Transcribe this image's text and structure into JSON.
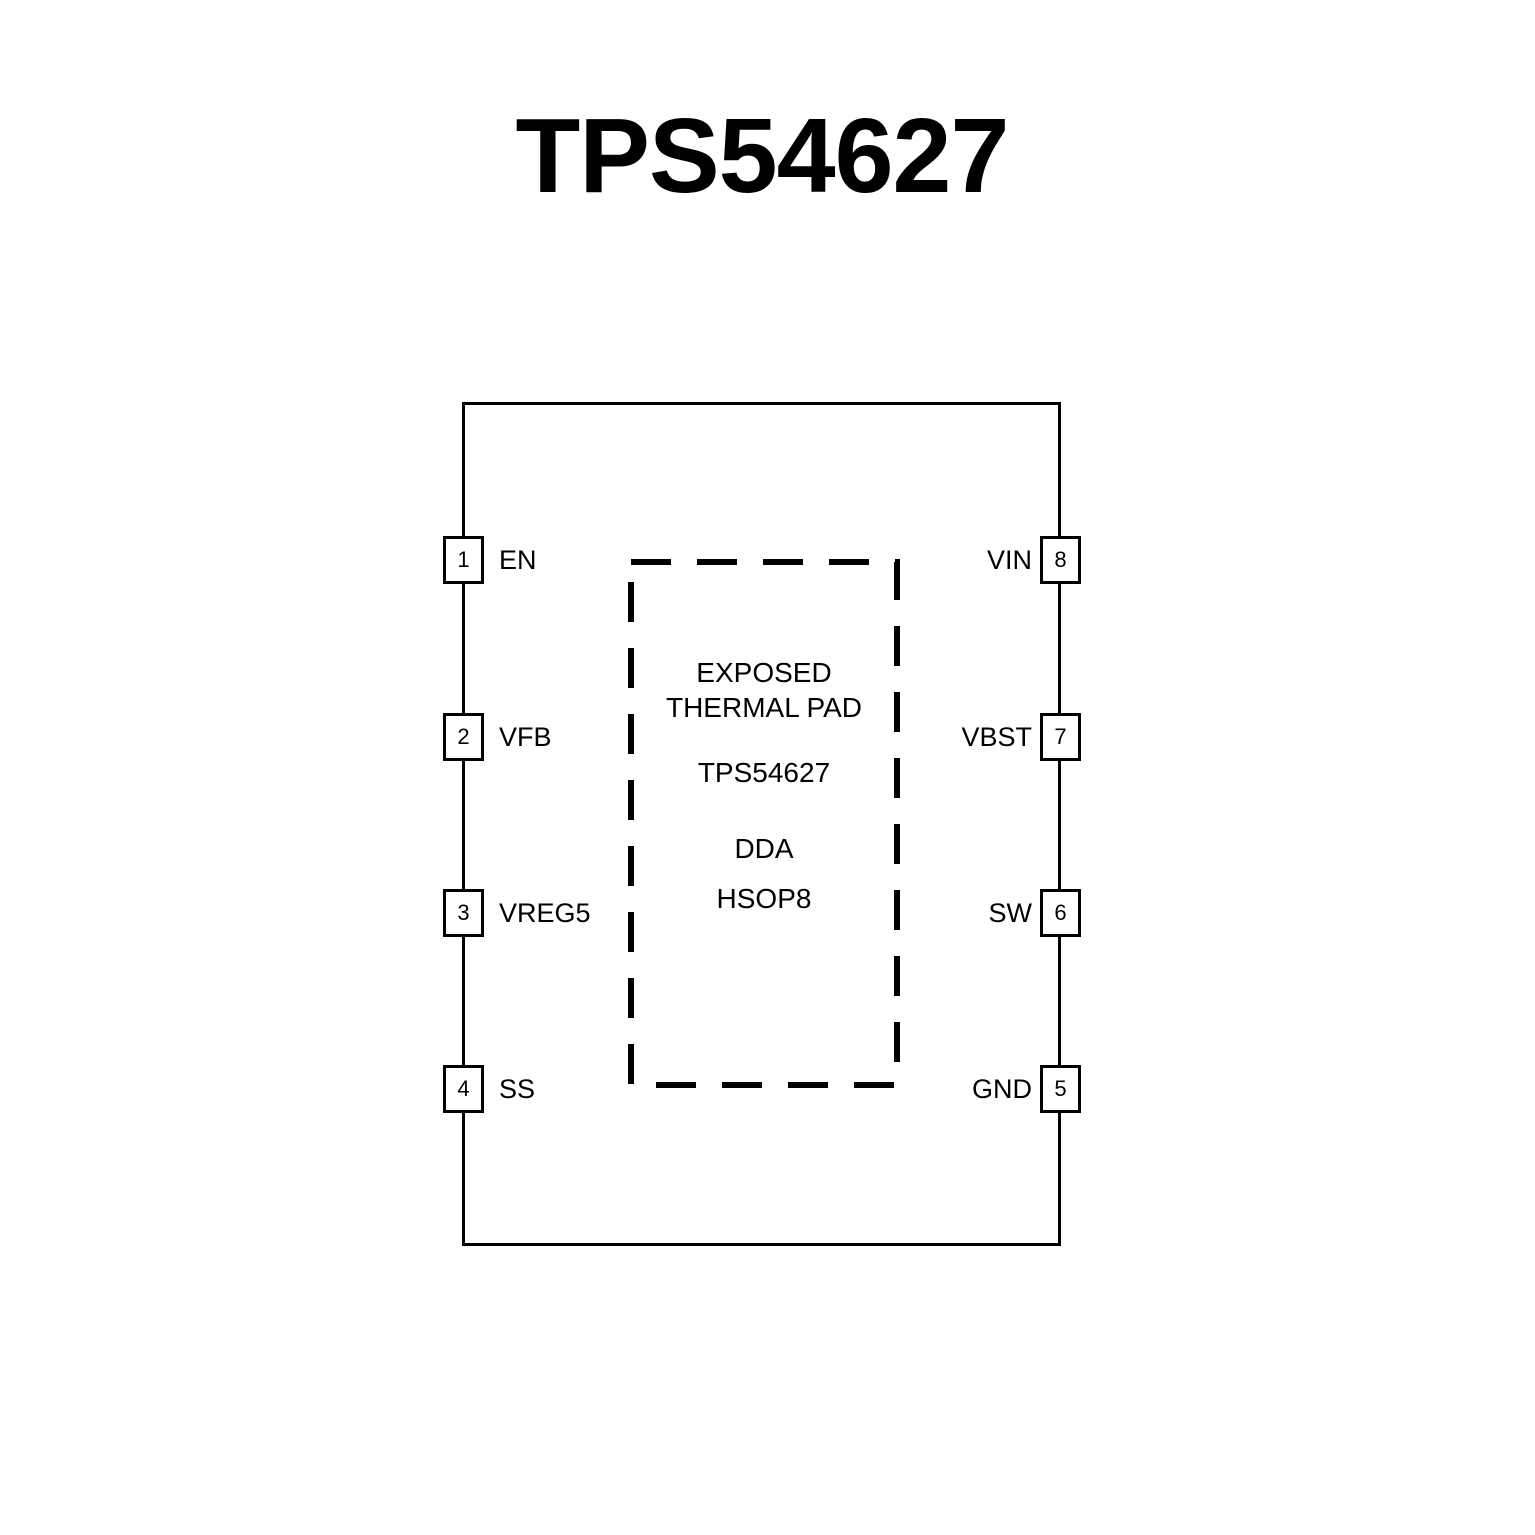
{
  "title": "TPS54627",
  "thermal_pad": {
    "line1": "EXPOSED",
    "line2": "THERMAL PAD",
    "part_number": "TPS54627",
    "package_code": "DDA",
    "package_name": "HSOP8"
  },
  "pins": {
    "left": [
      {
        "number": "1",
        "label": "EN"
      },
      {
        "number": "2",
        "label": "VFB"
      },
      {
        "number": "3",
        "label": "VREG5"
      },
      {
        "number": "4",
        "label": "SS"
      }
    ],
    "right": [
      {
        "number": "8",
        "label": "VIN"
      },
      {
        "number": "7",
        "label": "VBST"
      },
      {
        "number": "6",
        "label": "SW"
      },
      {
        "number": "5",
        "label": "GND"
      }
    ]
  },
  "colors": {
    "line": "#000000",
    "background": "#ffffff",
    "text": "#000000"
  }
}
